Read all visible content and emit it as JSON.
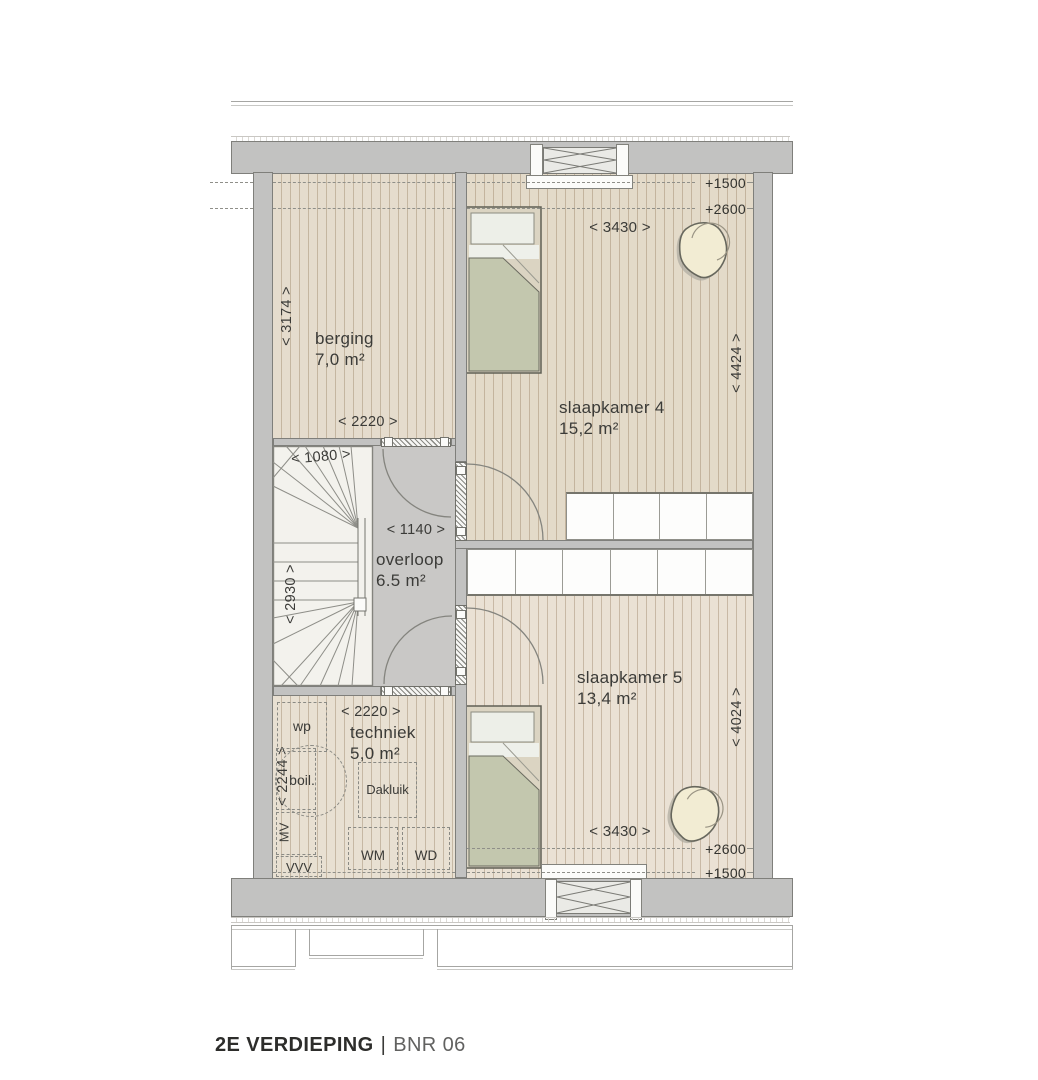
{
  "title": {
    "floor": "2E VERDIEPING",
    "separator": "|",
    "number": "BNR 06"
  },
  "rooms": {
    "berging": {
      "name": "berging",
      "area": "7,0 m²"
    },
    "slaapkamer4": {
      "name": "slaapkamer 4",
      "area": "15,2 m²"
    },
    "overloop": {
      "name": "overloop",
      "area": "6.5 m²"
    },
    "slaapkamer5": {
      "name": "slaapkamer 5",
      "area": "13,4 m²"
    },
    "techniek": {
      "name": "techniek",
      "area": "5,0 m²"
    }
  },
  "dimensions": {
    "d3174": "< 3174 >",
    "d2220_berging": "< 2220 >",
    "d1080": "< 1080 >",
    "d2930": "< 2930 >",
    "d1140": "< 1140 >",
    "d2220_techniek": "< 2220 >",
    "d2244": "< 2244 >",
    "d3430_slk4": "< 3430 >",
    "d4424": "< 4424 >",
    "d3430_slk5": "< 3430 >",
    "d4024": "< 4024 >"
  },
  "levels": {
    "top_1500": "+1500",
    "top_2600": "+2600",
    "bottom_2600": "+2600",
    "bottom_1500": "+1500"
  },
  "fixtures": {
    "wp": "wp",
    "boiler": "boil.",
    "dakluik": "Dakluik",
    "mv": "MV",
    "vvv": "VVV",
    "wm": "WM",
    "wd": "WD"
  },
  "colors": {
    "wall": "#c2c2c1",
    "wood_berging": "#e5dccd",
    "wood_slk4": "#e3dac9",
    "wood_slk5": "#eae1d4",
    "wood_techniek": "#e8e0d2",
    "landing": "#c9c8c6",
    "stair": "#f3f2ed",
    "blanket": "#c3c7ae",
    "pillow": "#edefe8",
    "beanbag": "#f2ecd3",
    "text": "#3a3a38"
  }
}
